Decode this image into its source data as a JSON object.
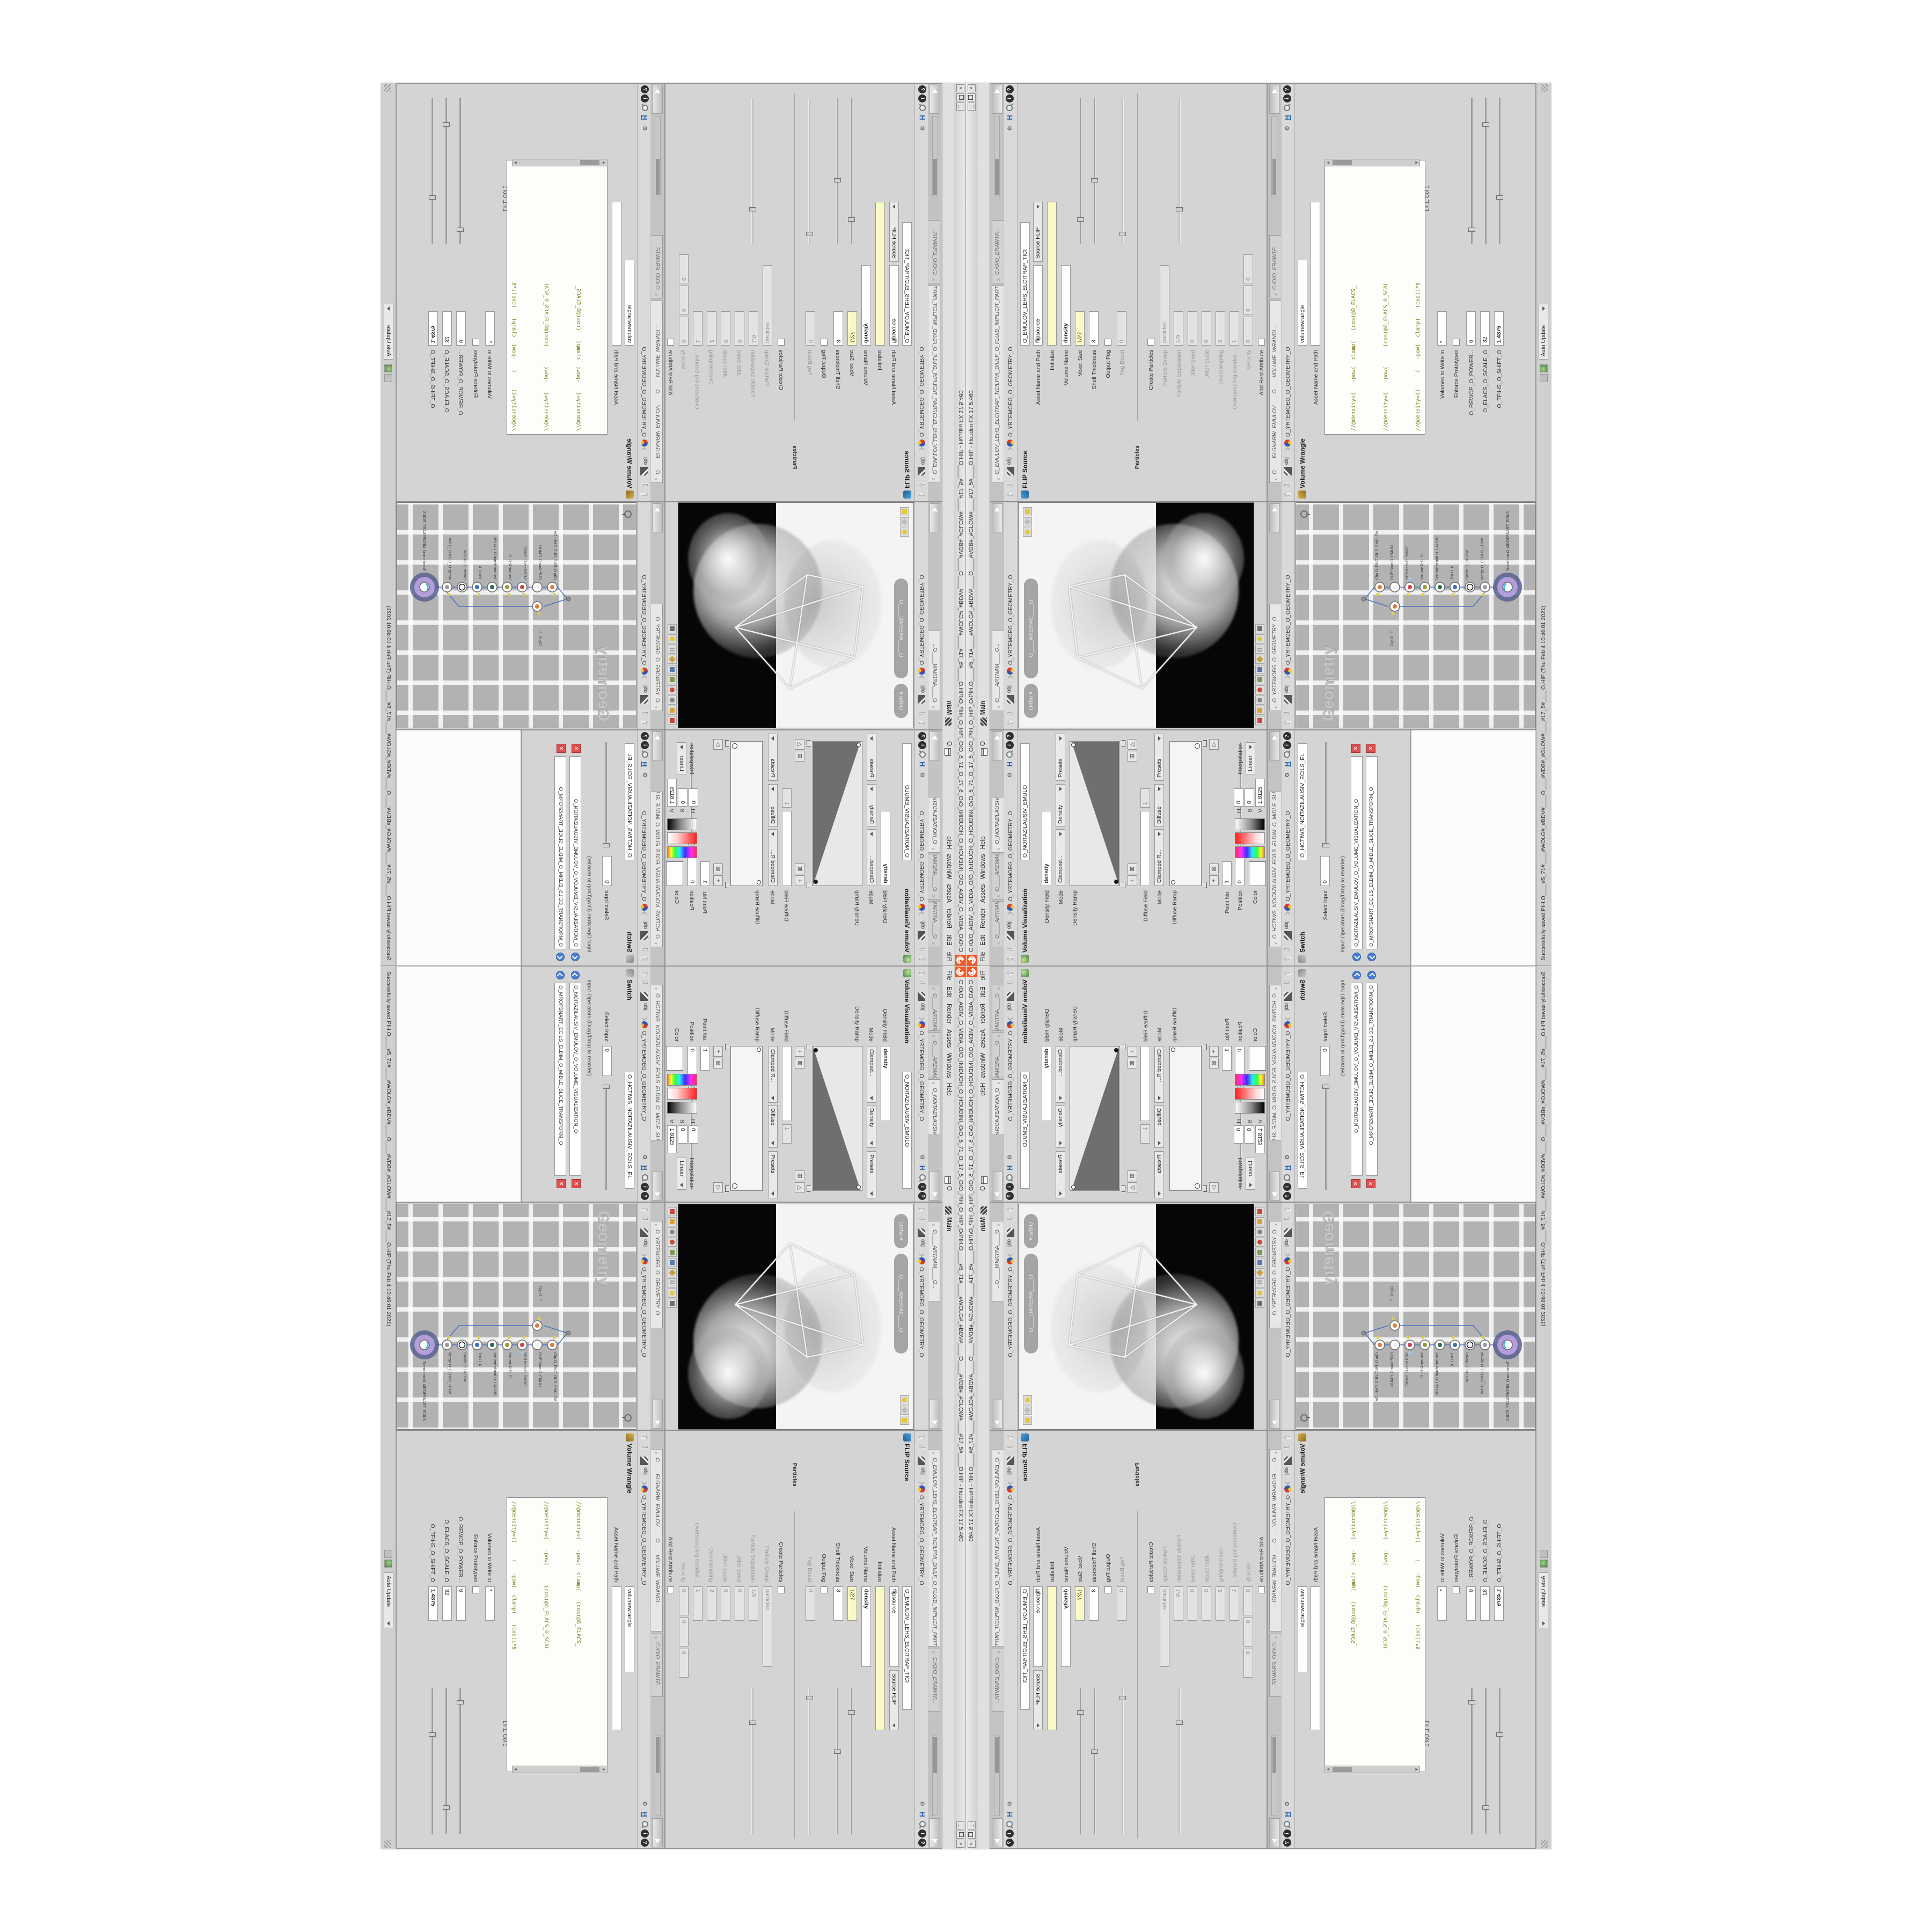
{
  "window": {
    "title": "C:/O/O_AIDIV_O_VIDIA_O/O_INIDUOH_O_HOUDINI_O/O_5_71_O_17_5_O/O_PIH_O_HIP_O/PIH.O____#5_71#____#WOLG#_#BDV#____O____#VDB#_#GLOW#____#17_5#____O.HIP - Houdini FX 17.5.460",
    "menu": [
      "File",
      "Edit",
      "Render",
      "Assets",
      "Windows",
      "Help"
    ],
    "win_o": "O",
    "desk": "Main",
    "close": "×",
    "logo_color": "#f05a28"
  },
  "status": {
    "message": "Successfully saved PIH.O____#5_71#____#WOLG#_#BDV#____O____#VDB#_#GLOW#____#17_5#____O.HIP  (Thu Feb  4 10:46:01 2021)",
    "update_mode": "Auto Update"
  },
  "paths": {
    "root": "obj",
    "geo": "O_YRTEMOEG_O_GEOMETRY_O"
  },
  "icons": {
    "h": "H",
    "info": "i",
    "help": "?",
    "gear": "⚙",
    "up": "⇧",
    "down": "⇩",
    "plus": "+",
    "boxplus": "⊞",
    "boxx": "⊠",
    "tri": "△",
    "tri_r": "▷"
  },
  "volviz": {
    "tab1": "O____ARTNAM____O...",
    "tab2": "O____AREMAC____O...",
    "tab3": "O_NOITAZILAUSIV...",
    "title": "Volume Visualization",
    "node": "O_NOITAZILAUSIV_EMULO",
    "density_field_l": "Density Field",
    "density_field": "density",
    "mode_l": "Mode",
    "mode1": "Clamped...",
    "mode1b": "Density",
    "presets": "Presets",
    "density_ramp_l": "Density Ramp",
    "diffuse_field_l": "Diffuse Field",
    "diffuse_range": "1",
    "mode2": "Clamped R...",
    "mode2b": "Diffuse",
    "diffuse_ramp_l": "Diffuse Ramp",
    "point_l": "Point No.",
    "point": "1",
    "pos_l": "Position",
    "pos": "0",
    "color_l": "Color",
    "h_l": "H",
    "h": "0",
    "s_l": "S",
    "s": "0",
    "v_l": "V",
    "v": "1.8125",
    "interp_l": "Interpolation",
    "interp": "Linear"
  },
  "sw": {
    "tab": "O_HCTIWS_NOITAZILAUSIV_ECILS_ELDIM_O_MIDLE_SLICE_VISUAL...",
    "title": "Switch",
    "node": "O_HCTIWS_NOITAZILAUSIV_ECILS_EL",
    "select_l": "Select Input",
    "select": "0",
    "ops_l": "Input Operators (Drag/Drop to reorder)",
    "item1": "O_NOITAZILAUSIV_EMULOV_O_VOLUME_VISUALIZATION_O",
    "item2": "O_MROFSNART_ECILS_ELDIM_O_MIDLE_SLICE_TRANSFORM_O",
    "x": "x"
  },
  "view": {
    "tab": "O____ARTNAM____O...",
    "cam": "O____AREMAC____O",
    "ortho": "Ortho ▾"
  },
  "net": {
    "tab": "O_YRTEMOEG_O_GEOMETRY_O",
    "watermark": "Geometry",
    "nodes": [
      {
        "n": "Clip  O_PILC_BUS_EMULOV"
      },
      {
        "n": "FLIP Sour  O_EMULI"
      },
      {
        "n": "VDB from  O_SMOG"
      },
      {
        "n": "Volume R  O_EL"
      },
      {
        "n": "Volume Visual  O_LAUSIV"
      },
      {
        "n": "Tra  O_R"
      },
      {
        "n": "Switch  O_HCTIW"
      },
      {
        "n": "Merge  O_ECRUS_HTIW"
      },
      {
        "n": "Transform  O_MROFSNART_ECILS"
      },
      {
        "n": "Clip  O_E"
      }
    ]
  },
  "flip": {
    "tab": "O_EMULOV_LEHS_ELCITRAP_TICILPMI_DIULF_O_FLUID_IMPLICIT_PARTI...",
    "tab2": "C:/O/O_ERAWTF...",
    "title": "FLIP Source",
    "node": "O_EMULOV_LEHS_ELCITRAP_TICI",
    "asset_l": "Asset Name and Path",
    "asset": "flipsource",
    "asset2": "Source FLIP",
    "init_l": "Initialize",
    "init": "",
    "volname_l": "Volume Name",
    "volname": "density",
    "voxel_l": "Voxel Size",
    "voxel": "1/27",
    "shell_l": "Shell Thickness",
    "shell": "3",
    "outputfog_l": "Output Fog",
    "fogboost_l": "Fog Boost",
    "fogboost": "0",
    "particles_l": "Particles",
    "createp_l": "Create Particles",
    "pgroup_l": "Particle Group",
    "pgroup": "particles",
    "psep_l": "Particle Separation",
    "psep": "1/9",
    "jseed_l": "Jitter Seed",
    "jseed": "0",
    "jscale_l": "Jitter Scale",
    "jscale": "0",
    "over_l": "Oversampling",
    "over": "2",
    "overbw_l": "Oversampling Bandwi...",
    "overbw": "1",
    "vel_l": "Velocity",
    "velx": "0",
    "vely": "0",
    "velz": "0",
    "rest_l": "Add Rest Attribute"
  },
  "wr": {
    "tab": "O____ELGNARW_EMULOV____O____VOLUME_WRANGL...",
    "tab2": "C:/O/O_ERAWTF...",
    "title": "Volume Wrangle",
    "node": "volumewrangle",
    "asset_l": "Asset Name and Path",
    "code": [
      "//@density=(   -pow(  clamp(   (cos(@O_ELACS_",
      "//@density=(   -pow(      (cos(@O_ELACS_O_SCAL",
      "//@density=((     (   -pow(  clamp(   (cos(1*$",
      "//@density=(    -pow(     (cos((clamp(@O_TFIHS",
      "//@density=((     (   -pow(  clamp(   (cos( c(",
      "//@density=((          (pow((      1./",
      "//@density=((pow((      1./ (1.-clamp("
    ],
    "code_last_pre": "@density=(( ((",
    "code_kw": "pow",
    "code_last_post": "((   1./ (",
    "lncol": "Ln 1, Col 1",
    "volwrite_l": "Volumes to Write to",
    "volwrite": "*",
    "enforce_l": "Enforce Prototypes",
    "p1_l": "O_REWOP_O_POWER...",
    "p1": "6",
    "p2_l": "O_ELACS_O_SCALE_O",
    "p2": "32",
    "p3_l": "O_TFIHS_O_SHIFT_O",
    "p3": "1.4375"
  }
}
